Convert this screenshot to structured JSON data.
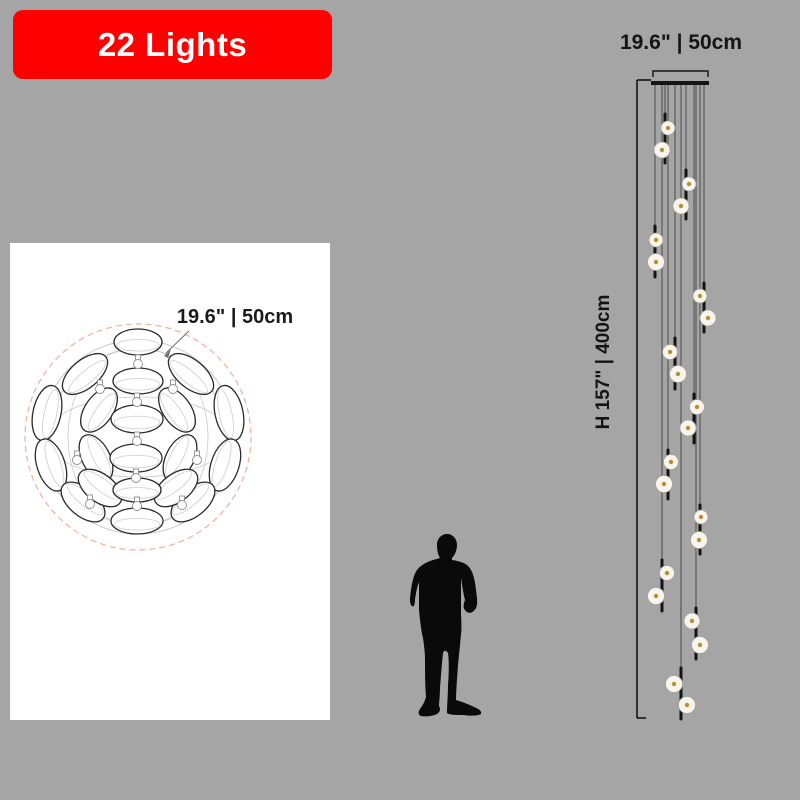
{
  "page": {
    "bg": "#a5a5a5"
  },
  "banner": {
    "label": "22 Lights",
    "bg": "#fe0000",
    "text_color": "#ffffff"
  },
  "card": {
    "bg": "#ffffff",
    "dimension_label": "19.6\" | 50cm",
    "drawing": {
      "center": {
        "cx": 128,
        "cy": 194
      },
      "dashed_circle": {
        "r": 113,
        "color": "#efb29c"
      },
      "wire_circles": [
        97,
        88
      ],
      "wire_ellipses": [
        {
          "rx": 93,
          "ry": 40
        },
        {
          "rx": 70,
          "ry": 90
        }
      ],
      "wire_color": "#c9c9c9",
      "disc_stroke": "#2b2b2b",
      "disc_inner_stroke": "#d2d2d2",
      "discs": [
        {
          "cx": 75,
          "cy": 131,
          "rx": 27,
          "ry": 14,
          "rot": -40
        },
        {
          "cx": 181,
          "cy": 131,
          "rx": 27,
          "ry": 14,
          "rot": 40
        },
        {
          "cx": 37,
          "cy": 170,
          "rx": 28,
          "ry": 14,
          "rot": -78
        },
        {
          "cx": 219,
          "cy": 170,
          "rx": 28,
          "ry": 14,
          "rot": 78
        },
        {
          "cx": 41,
          "cy": 222,
          "rx": 27,
          "ry": 14,
          "rot": -108
        },
        {
          "cx": 215,
          "cy": 222,
          "rx": 27,
          "ry": 14,
          "rot": 108
        },
        {
          "cx": 73,
          "cy": 259,
          "rx": 26,
          "ry": 14,
          "rot": -140
        },
        {
          "cx": 183,
          "cy": 259,
          "rx": 26,
          "ry": 14,
          "rot": 140
        },
        {
          "cx": 89,
          "cy": 167,
          "rx": 25,
          "ry": 14,
          "rot": -55
        },
        {
          "cx": 167,
          "cy": 167,
          "rx": 25,
          "ry": 14,
          "rot": 55
        },
        {
          "cx": 86,
          "cy": 215,
          "rx": 25,
          "ry": 14,
          "rot": -117
        },
        {
          "cx": 170,
          "cy": 215,
          "rx": 25,
          "ry": 14,
          "rot": 117
        },
        {
          "cx": 90,
          "cy": 245,
          "rx": 25,
          "ry": 14,
          "rot": -143
        },
        {
          "cx": 166,
          "cy": 245,
          "rx": 25,
          "ry": 14,
          "rot": 143
        },
        {
          "cx": 128,
          "cy": 99,
          "rx": 24,
          "ry": 13,
          "rot": 0
        },
        {
          "cx": 128,
          "cy": 138,
          "rx": 25,
          "ry": 13,
          "rot": 0
        },
        {
          "cx": 127,
          "cy": 176,
          "rx": 26,
          "ry": 14,
          "rot": 0
        },
        {
          "cx": 126,
          "cy": 215,
          "rx": 26,
          "ry": 14,
          "rot": 0
        },
        {
          "cx": 127,
          "cy": 247,
          "rx": 24,
          "ry": 12,
          "rot": 0
        },
        {
          "cx": 127,
          "cy": 278,
          "rx": 26,
          "ry": 13,
          "rot": 0
        }
      ],
      "connectors": [
        {
          "cx": 128,
          "cy": 119
        },
        {
          "cx": 127,
          "cy": 157
        },
        {
          "cx": 127,
          "cy": 196
        },
        {
          "cx": 126,
          "cy": 233
        },
        {
          "cx": 127,
          "cy": 261
        },
        {
          "cx": 90,
          "cy": 144
        },
        {
          "cx": 163,
          "cy": 144
        },
        {
          "cx": 67,
          "cy": 215
        },
        {
          "cx": 187,
          "cy": 215
        },
        {
          "cx": 80,
          "cy": 259
        },
        {
          "cx": 172,
          "cy": 260
        }
      ],
      "leader": {
        "x1": 179,
        "y1": 88,
        "x2": 156,
        "y2": 110
      }
    }
  },
  "figure": {
    "color": "#0a0a0a"
  },
  "fixture": {
    "width_label": "19.6\" | 50cm",
    "height_label": "H 157\" | 400cm",
    "lights_count": "22",
    "colors": {
      "cable": "#4c4c4c",
      "rod": "#141414",
      "disc_fill": "#f8f5ef",
      "disc_stroke": "#a9a298",
      "dot": "#b9902e",
      "line": "#141414"
    },
    "canopy": {
      "x": 651,
      "y": 81,
      "w": 58,
      "h": 4
    },
    "bracket": {
      "x1": 653,
      "x2": 708,
      "y": 71,
      "tick": 6
    },
    "dim_line": {
      "x": 637,
      "y1": 80,
      "y2": 718,
      "top_tick": 14,
      "bottom_tick": 9
    },
    "units": [
      {
        "x": 665,
        "top": 114,
        "bottom": 163,
        "d1": [
          668,
          128,
          7
        ],
        "d2": [
          662,
          150,
          8
        ]
      },
      {
        "x": 686,
        "top": 170,
        "bottom": 219,
        "d1": [
          689,
          184,
          7
        ],
        "d2": [
          681,
          206,
          8
        ]
      },
      {
        "x": 655,
        "top": 226,
        "bottom": 277,
        "d1": [
          656,
          240,
          7
        ],
        "d2": [
          656,
          262,
          8.5
        ]
      },
      {
        "x": 704,
        "top": 283,
        "bottom": 332,
        "d1": [
          700,
          296,
          7
        ],
        "d2": [
          708,
          318,
          8
        ]
      },
      {
        "x": 675,
        "top": 338,
        "bottom": 389,
        "d1": [
          670,
          352,
          7.5
        ],
        "d2": [
          678,
          374,
          8.5
        ]
      },
      {
        "x": 694,
        "top": 394,
        "bottom": 443,
        "d1": [
          697,
          407,
          7.5
        ],
        "d2": [
          688,
          428,
          8
        ]
      },
      {
        "x": 668,
        "top": 450,
        "bottom": 499,
        "d1": [
          671,
          462,
          7.5
        ],
        "d2": [
          664,
          484,
          8.5
        ]
      },
      {
        "x": 700,
        "top": 505,
        "bottom": 554,
        "d1": [
          701,
          517,
          7
        ],
        "d2": [
          699,
          540,
          8.5
        ]
      },
      {
        "x": 662,
        "top": 560,
        "bottom": 611,
        "d1": [
          667,
          573,
          7.5
        ],
        "d2": [
          656,
          596,
          8.5
        ]
      },
      {
        "x": 696,
        "top": 608,
        "bottom": 659,
        "d1": [
          692,
          621,
          8
        ],
        "d2": [
          700,
          645,
          8.5
        ]
      },
      {
        "x": 681,
        "top": 668,
        "bottom": 719,
        "d1": [
          674,
          684,
          8.5
        ],
        "d2": [
          687,
          705,
          8.5
        ]
      }
    ]
  }
}
